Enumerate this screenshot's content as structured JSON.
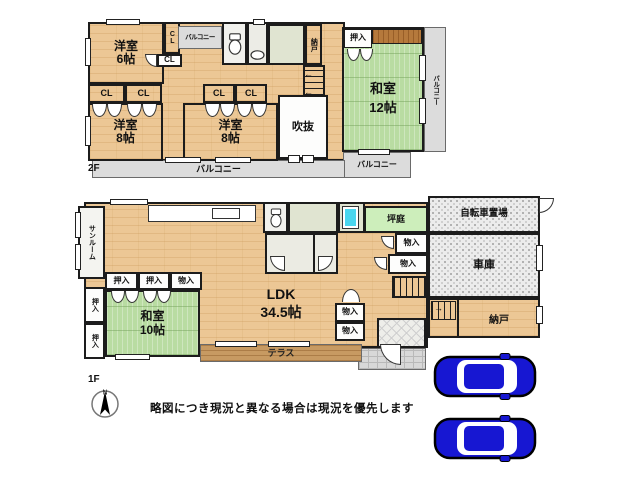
{
  "f2": {
    "label": "2F",
    "rooms": {
      "west6": {
        "name": "洋室",
        "size": "6帖"
      },
      "west8": {
        "name": "洋室",
        "size": "8帖"
      },
      "wa12": {
        "name": "和室",
        "size": "12帖"
      },
      "void": "吹抜",
      "oshiire": "押入",
      "nando": "納戸",
      "cl": "CL",
      "balcony": "バルコニー"
    }
  },
  "f1": {
    "label": "1F",
    "rooms": {
      "sunroom": "サンルーム",
      "wa10": {
        "name": "和室",
        "size": "10帖"
      },
      "ldk": {
        "name": "LDK",
        "size": "34.5帖"
      },
      "tsubo": "坪庭",
      "oshiire": "押入",
      "mono": "物入",
      "terrace": "テラス",
      "nando": "納戸",
      "garage": "車庫",
      "bicycle": "自転車置場"
    }
  },
  "footer": {
    "disclaimer": "略図につき現況と異なる場合は現況を優先します",
    "compass_n": "N"
  },
  "colors": {
    "wood": "#ecc795",
    "tatami": "#b9dca2",
    "garden": "#cdeebb",
    "bathtub": "#49d6ee",
    "car": "#1717d2"
  }
}
